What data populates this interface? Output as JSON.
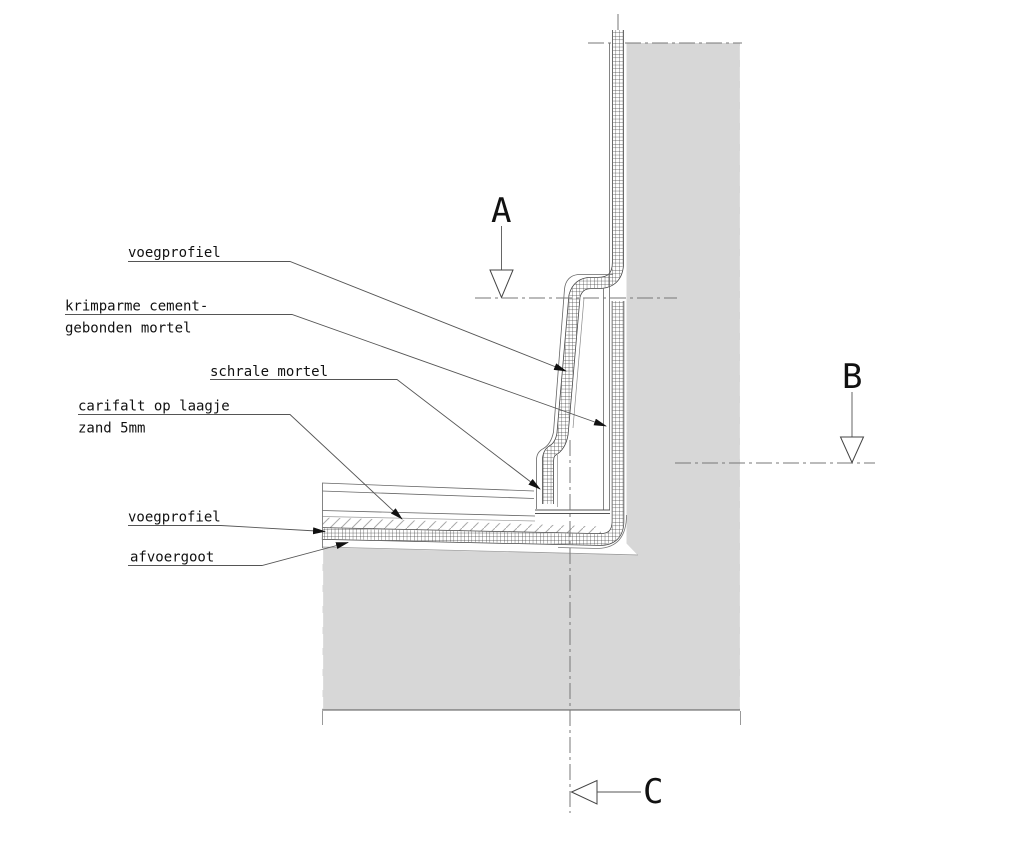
{
  "drawing": {
    "type": "construction-detail-section",
    "labels": {
      "voegprofiel_top": "voegprofiel",
      "krimparme_1": "krimparme cement-",
      "krimparme_2": "gebonden mortel",
      "schrale": "schrale mortel",
      "carifalt_1": "carifalt op laagje",
      "carifalt_2": "zand 5mm",
      "voegprofiel_bottom": "voegprofiel",
      "afvoergoot": "afvoergoot"
    },
    "section_markers": {
      "a": "A",
      "b": "B",
      "c": "C"
    },
    "colors": {
      "concrete_fill": "#d7d7d7",
      "line": "#555555",
      "hatch": "#3a3a3a",
      "text": "#111111"
    }
  }
}
